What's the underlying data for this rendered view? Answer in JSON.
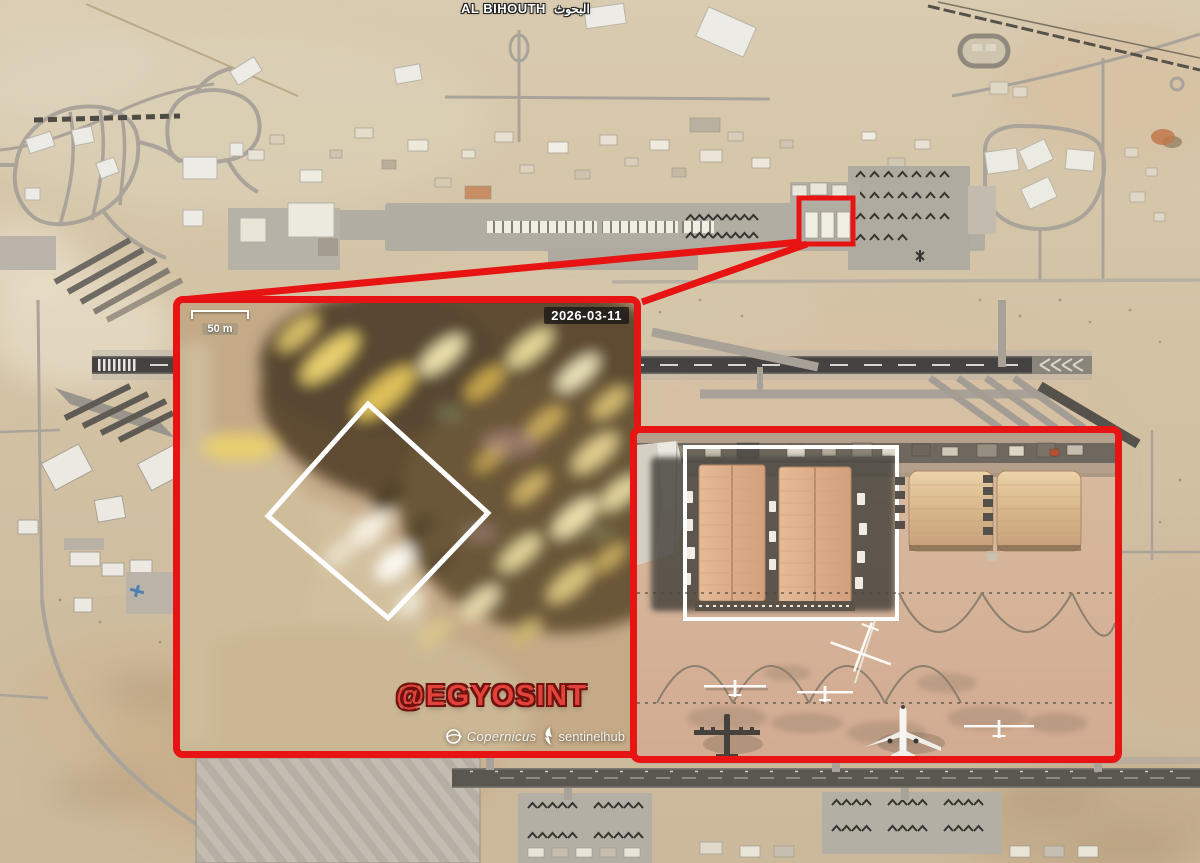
{
  "map": {
    "place_label": "AL BIHOUTH",
    "place_label_arabic": "البحوث"
  },
  "annotation": {
    "highlight_red": "#e81414",
    "highlight_white": "#ffffff"
  },
  "left_inset": {
    "scale_label": "50 m",
    "date_label": "2026-03-11",
    "watermark": "@EGYOSINT",
    "credits": {
      "copernicus_label": "Copernicus",
      "sentinelhub_label": "sentinelhub"
    }
  }
}
